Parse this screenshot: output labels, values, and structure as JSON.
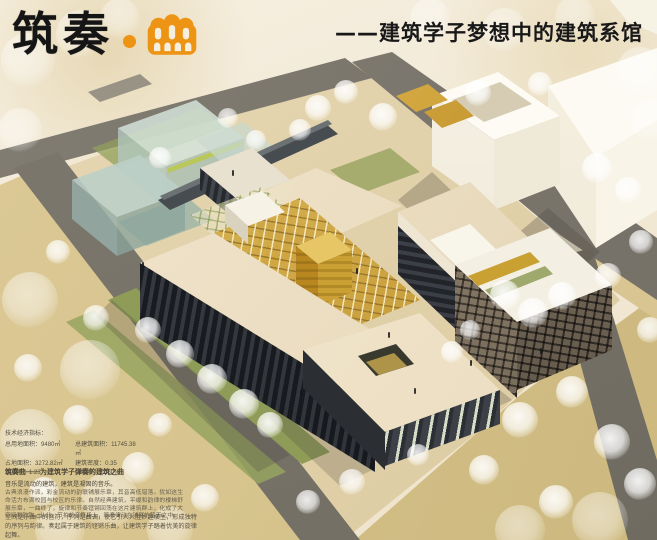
{
  "header": {
    "title": "筑奏",
    "separator": "·",
    "logo_glyph": "曲",
    "subtitle": "——建筑学子梦想中的建筑系馆"
  },
  "palette": {
    "accent_orange": "#ED9414",
    "title_black": "#151515",
    "roof_cream": "#F0E4CB",
    "facade_dark": "#32363C",
    "gold_glass": "#C9992F",
    "glass_green": "#BCCFC5",
    "road_gray": "#7D796F",
    "ground_khaki": "#D5C28C",
    "lawn_green": "#8F9C58",
    "context_white": "#FAF7EE"
  },
  "stats": {
    "heading": "技术经济指标：",
    "items": [
      {
        "label": "总用地面积：",
        "value": "9480㎡"
      },
      {
        "label": "总建筑面积：",
        "value": "11745.38㎡"
      },
      {
        "label": "占地面积：",
        "value": "3272.82㎡"
      },
      {
        "label": "建筑密度：",
        "value": "0.35"
      },
      {
        "label": "容积率：",
        "value": "1.23"
      },
      {
        "label": "绿地率：",
        "value": "32.60%"
      }
    ]
  },
  "description": {
    "slogan_title": "筑奏曲——为建筑学子弹奏的建筑之曲",
    "slogan_sub": "音乐是流动的建筑，建筑是凝固的音乐。",
    "body": "古典浪漫作派，彩金流动的韵联铺展乐章，其音高低错落，犹如这生命活力布满校园与校区的乐律。自然经典建筑，平缓和韵律的楼梯舒展乐章，一曲终了，旋律和节奏铿锵回荡在这片建筑群上，化成了大空间和韵致。从此，节拍的音符场上，筑奏律动在铺展的蓝天之中。",
    "footer": "空间是乐曲中的音符，序列是曲调，使它引人入胜妙趣横生，形成独特的序列与韵律。奏起属于建筑的铿锵乐曲，让建筑学子踏着优美的旋律起舞。"
  }
}
